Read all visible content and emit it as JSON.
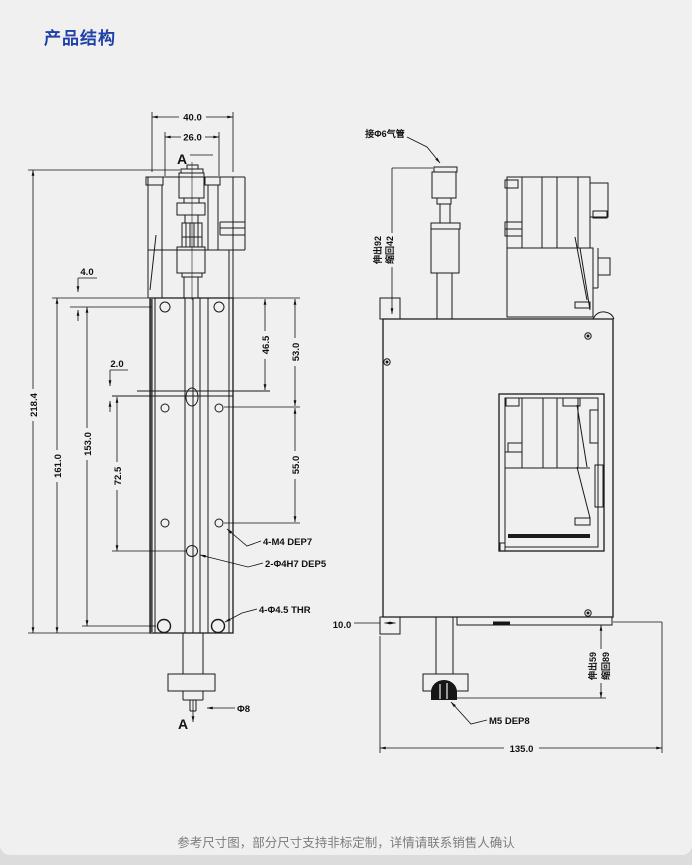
{
  "page": {
    "title": "产品结构",
    "footer": "参考尺寸图，部分尺寸支持非标定制，详情请联系销售人确认",
    "accent_color": "#1f41a8",
    "line_color": "#1a1a1a"
  },
  "front_view": {
    "section_top": "A",
    "section_bottom": "A",
    "dims": {
      "overall_width": "40.0",
      "fitting_width": "26.0",
      "overall_height": "218.4",
      "body_height": "161.0",
      "hole_span": "153.0",
      "dowel_pitch": "72.5",
      "edge_to_holes": "4.0",
      "slot_offset": "2.0",
      "top_to_dowel": "46.5",
      "top_to_row2": "53.0",
      "row2_to_row3": "55.0",
      "rod_diameter": "Φ8"
    },
    "callouts": {
      "mount_holes": "4-M4 DEP7",
      "dowel_holes": "2-Φ4H7 DEP5",
      "thru_holes": "4-Φ4.5 THR"
    }
  },
  "side_view": {
    "air_port": "接Φ6气管",
    "upper_stroke": {
      "extend": "伸出92",
      "retract": "缩回42"
    },
    "lower_stroke": {
      "extend": "伸出59",
      "retract": "缩回89"
    },
    "dims": {
      "block_width": "10.0",
      "overall_length": "135.0"
    },
    "callouts": {
      "rod_thread": "M5 DEP8"
    }
  }
}
